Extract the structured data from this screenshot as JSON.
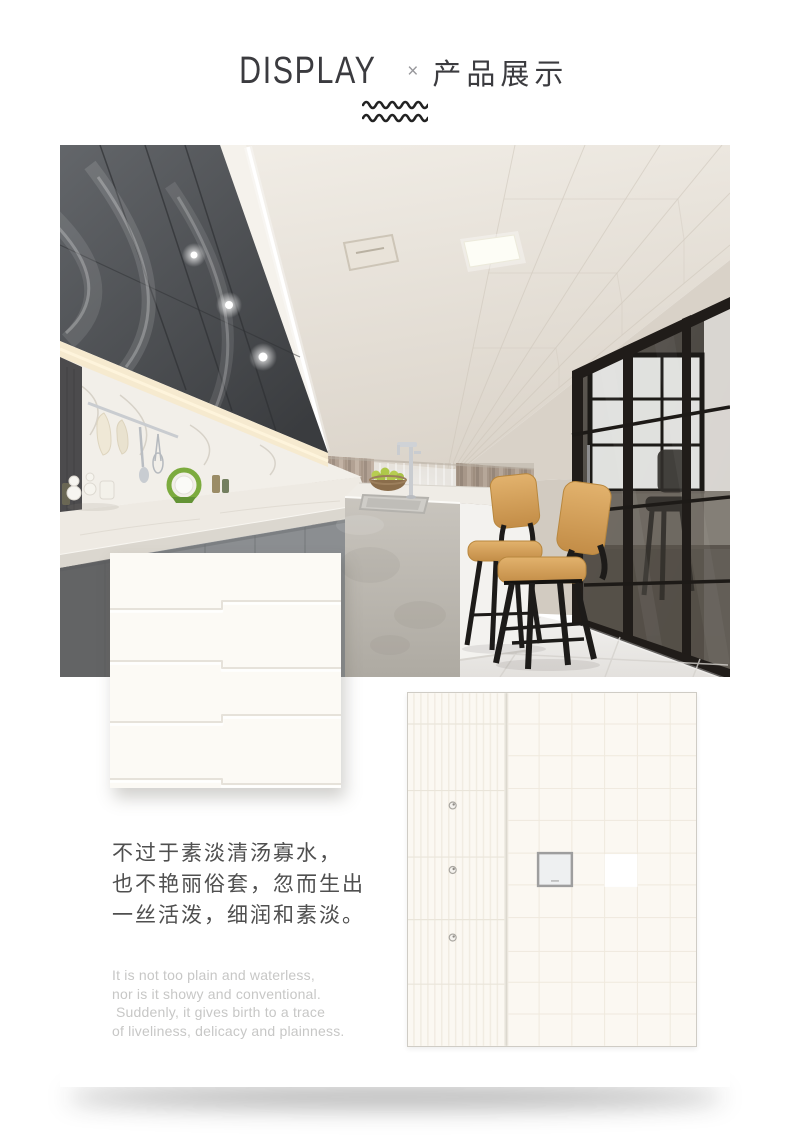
{
  "header": {
    "title_latin": "DISPLAY",
    "separator": "×",
    "title_cjk": "产品展示",
    "divider_icon": "double-wave-lines"
  },
  "intro": {
    "zh_lines": [
      "不过于素淡清汤寡水，",
      "也不艳丽俗套，忽而生出",
      "一丝活泼，细润和素淡。"
    ],
    "en_lines": [
      "It is not too plain and waterless,",
      "nor is it showy and conventional.",
      "Suddenly, it gives birth to a trace",
      "of liveliness, delicacy and plainness."
    ]
  },
  "media": {
    "kitchen_photo": "kitchen interior with gray cabinets, island, bar stools, glass partition",
    "swatch_panel": "cream staggered ceiling-panel swatch",
    "layout_figure": "ceiling panel grid plan with three downlights, one vent unit and one light panel"
  },
  "colors": {
    "card": "#ffffff",
    "title_text": "#3b3b3f",
    "separator_text": "#97979b",
    "zh_text": "#4f4f4f",
    "en_text": "#c7c7c6",
    "panel_cream": "#fcfaf5",
    "figure_bg": "#fbf8f2",
    "cabinet_dark": "#45474a",
    "curtain_taupe": "#b2a193",
    "stool_wood": "#d9a75f"
  }
}
